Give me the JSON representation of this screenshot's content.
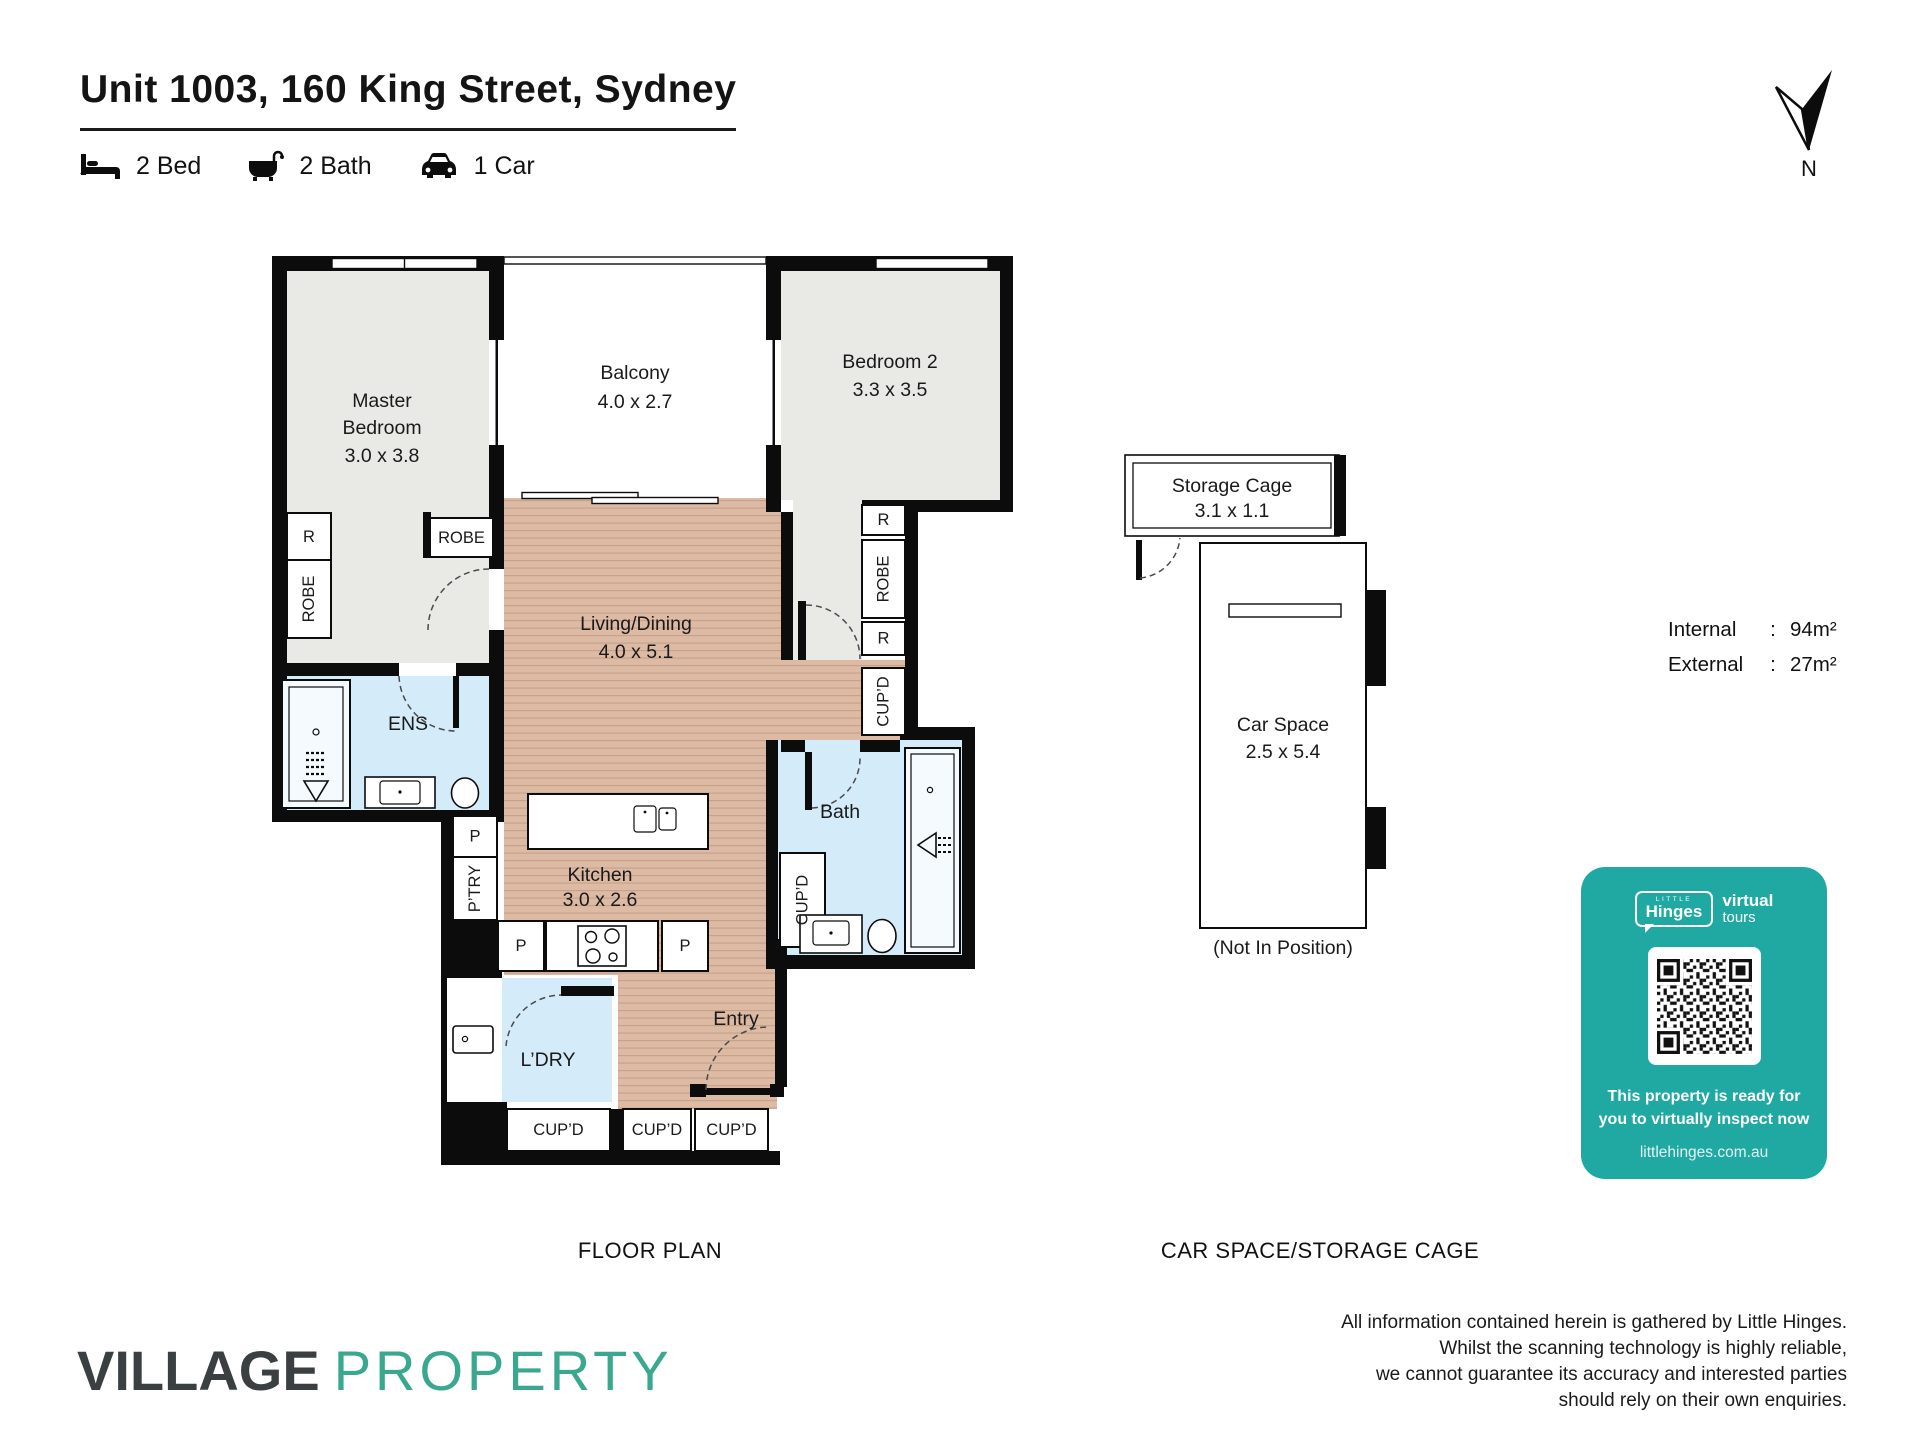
{
  "header": {
    "title": "Unit 1003, 160 King Street, Sydney",
    "features": [
      {
        "icon": "bed-icon",
        "label": "2 Bed"
      },
      {
        "icon": "bath-icon",
        "label": "2 Bath"
      },
      {
        "icon": "car-icon",
        "label": "1 Car"
      }
    ],
    "north_label": "N"
  },
  "plan": {
    "caption": "FLOOR PLAN",
    "rooms": {
      "master": {
        "line1": "Master",
        "line2": "Bedroom",
        "dims": "3.0 x 3.8"
      },
      "balcony": {
        "name": "Balcony",
        "dims": "4.0 x 2.7"
      },
      "bedroom2": {
        "name": "Bedroom 2",
        "dims": "3.3 x 3.5"
      },
      "living": {
        "name": "Living/Dining",
        "dims": "4.0 x 5.1"
      },
      "kitchen": {
        "name": "Kitchen",
        "dims": "3.0 x 2.6"
      },
      "ens": "ENS",
      "bath": "Bath",
      "ldry": "L’DRY",
      "entry": "Entry"
    },
    "labels": {
      "r": "R",
      "robe": "ROBE",
      "cupd": "CUP’D",
      "p": "P",
      "ptry": "P’TRY"
    }
  },
  "car": {
    "caption": "CAR SPACE/STORAGE CAGE",
    "storage": {
      "name": "Storage Cage",
      "dims": "3.1 x 1.1"
    },
    "space": {
      "name": "Car Space",
      "dims": "2.5 x 5.4"
    },
    "note": "(Not In Position)"
  },
  "areas": {
    "rows": [
      {
        "label": "Internal",
        "colon": ":",
        "value": "94m²"
      },
      {
        "label": "External",
        "colon": ":",
        "value": "27m²"
      }
    ]
  },
  "promo": {
    "little": "LITTLE",
    "name": "Hinges",
    "virtual": "virtual",
    "tours": "tours",
    "line1": "This property is ready for",
    "line2": "you to virtually inspect now",
    "url": "littlehinges.com.au"
  },
  "footer": {
    "brand1": "VILLAGE",
    "brand2": "PROPERTY",
    "disclaimer": [
      "All information contained herein is gathered by Little Hinges.",
      "Whilst the scanning technology is highly reliable,",
      "we cannot guarantee its accuracy and interested parties",
      "should rely on their own enquiries."
    ]
  },
  "colors": {
    "teal": "#1fa9a2",
    "logo_dark": "#3a3f41",
    "logo_teal": "#3aa78f",
    "wood": "#dcbaa4",
    "carpet": "#e9e9e6",
    "wet": "#d4ebf9"
  }
}
